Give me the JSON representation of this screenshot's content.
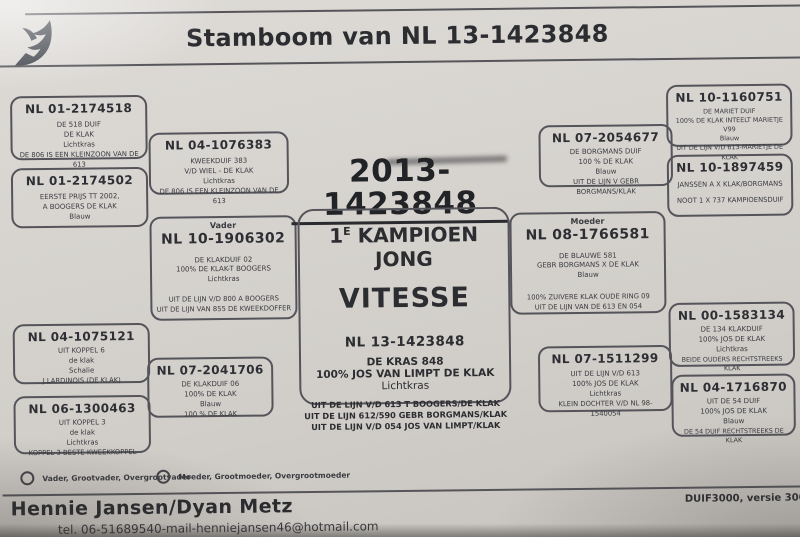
{
  "header": {
    "title": "Stamboom van NL 13-1423848",
    "logo": "pigeon-icon"
  },
  "subject": {
    "year_ring": "2013-1423848",
    "champion_no": "1",
    "champion_sup": "E",
    "champion_title": "KAMPIOEN JONG",
    "discipline": "VITESSE",
    "ring": "NL 13-1423848",
    "name": "DE KRAS 848",
    "strain": "100% JOS VAN LIMPT DE KLAK",
    "color": "Lichtkras",
    "notes": [
      "UIT DE LIJN V/D 613 T BOOGERS/DE KLAK",
      "UIT DE LIJN 612/590 GEBR BORGMANS/KLAK",
      "UIT DE LIJN V/D 054 JOS VAN LIMPT/KLAK"
    ]
  },
  "boxes": [
    {
      "ring": "NL 01-2174518",
      "lines": [
        "DE 518 DUIF",
        "DE KLAK",
        "Lichtkras"
      ],
      "notes": [
        "DE 806 IS EEN KLEINZOON VAN DE 613"
      ]
    },
    {
      "ring": "NL 04-1076383",
      "lines": [
        "KWEEKDUIF 383",
        "V/D WIEL - DE KLAK",
        "Lichtkras"
      ],
      "notes": [
        "DE 806 IS EEN KLEINZOON VAN DE 613"
      ]
    },
    {
      "ring": "NL 01-2174502",
      "lines": [
        "EERSTE PRIJS TT 2002,",
        "A BOOGERS DE KLAK",
        "Blauw"
      ],
      "notes": []
    },
    {
      "role": "Vader",
      "ring": "NL 10-1906302",
      "lines": [
        "DE KLAKDUIF 02",
        "100% DE KLAK-T BOOGERS",
        "Lichtkras"
      ],
      "notes": [
        "UIT DE LIJN V/D 800 A BOOGERS",
        "UIT DE LIJN VAN 855 DE KWEEKDOFFER"
      ]
    },
    {
      "ring": "NL 04-1075121",
      "lines": [
        "UIT KOPPEL 6",
        "de klak",
        "Schalie"
      ],
      "notes": [
        "J LARDINOIS (DE KLAK)"
      ]
    },
    {
      "ring": "NL 07-2041706",
      "lines": [
        "DE KLAKDUIF 06",
        "100% DE KLAK",
        "Blauw"
      ],
      "notes": [
        "100 % DE KLAK"
      ]
    },
    {
      "ring": "NL 06-1300463",
      "lines": [
        "UIT KOPPEL 3",
        "de klak",
        "Lichtkras"
      ],
      "notes": [
        "KOPPEL 3 BESTE KWEEKKOPPEL"
      ]
    },
    {
      "ring": "NL 07-2054677",
      "lines": [
        "DE BORGMANS DUIF",
        "100 % DE KLAK",
        "Blauw"
      ],
      "notes": [
        "UIT DE LIJN V GEBR BORGMANS/KLAK"
      ]
    },
    {
      "ring": "NL 10-1160751",
      "lines": [
        "DE MARIET DUIF",
        "100% DE KLAK INTEELT MARIETJE V99",
        "Blauw"
      ],
      "notes": [
        "UIT DE LIJN V/D 613-MARIETJE DE KLAK"
      ]
    },
    {
      "ring": "NL 10-1897459",
      "lines": [],
      "notes": [
        "JANSSEN A X KLAK/BORGMANS",
        "NOOT 1 X 737 KAMPIOENSDUIF"
      ]
    },
    {
      "role": "Moeder",
      "ring": "NL 08-1766581",
      "lines": [
        "DE BLAUWE 581",
        "GEBR BORGMANS X DE KLAK",
        "Blauw"
      ],
      "notes": [
        "100% ZUIVERE KLAK OUDE RING 09",
        "UIT DE LIJN VAN DE 613 EN 054"
      ]
    },
    {
      "ring": "NL 07-1511299",
      "lines": [
        "UIT DE LIJN V/D 613",
        "100% JOS DE KLAK",
        "Lichtkras"
      ],
      "notes": [
        "KLEIN DOCHTER V/D NL 98-1540054"
      ]
    },
    {
      "ring": "NL 00-1583134",
      "lines": [
        "DE 134 KLAKDUIF",
        "100% JOS DE KLAK",
        "Lichtkras"
      ],
      "notes": [
        "BEIDE OUDERS RECHTSTREEKS KLAK"
      ]
    },
    {
      "ring": "NL 04-1716870",
      "lines": [
        "UIT DE 54 DUIF",
        "100% JOS DE KLAK",
        "Blauw"
      ],
      "notes": [
        "DE 54 DUIF RECHTSTREEKS DE KLAK"
      ]
    }
  ],
  "legend": {
    "father_label": "Vader, Grootvader, Overgrootvader",
    "mother_label": "Moeder, Grootmoeder, Overgrootmoeder"
  },
  "footer": {
    "owner": "Hennie Jansen/Dyan Metz",
    "contact": "tel. 06-51689540-mail-henniejansen46@hotmail.com",
    "software": "DUIF3000, versie 300"
  },
  "colors": {
    "paper": "#d5d2cd",
    "ink": "#35363a",
    "border": "#54545a"
  }
}
